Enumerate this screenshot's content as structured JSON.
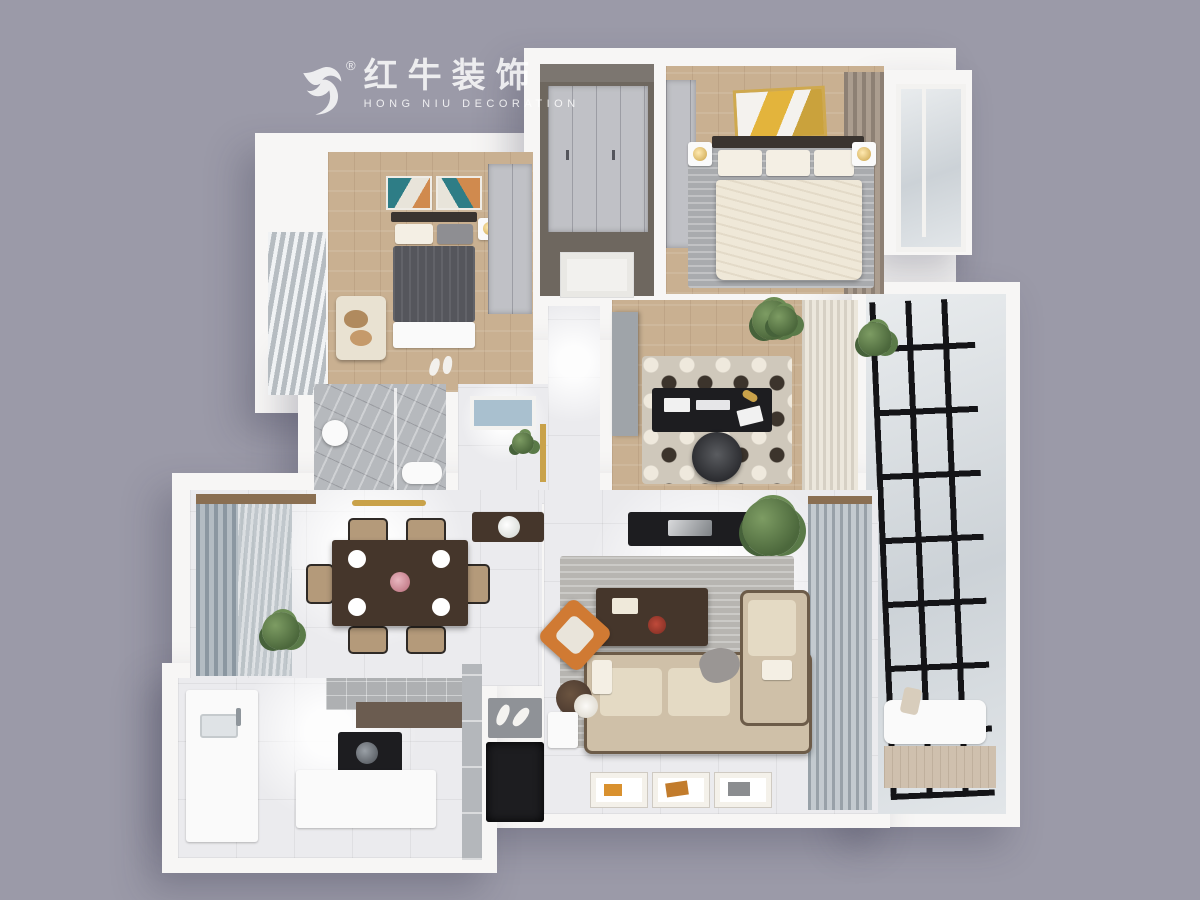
{
  "watermark": {
    "brand_cn": "红牛装饰",
    "brand_en": "HONG NIU DECORATION",
    "registered_mark": "®"
  },
  "palette": {
    "background": "#9b9aa8",
    "wall_white": "#f7f6f5",
    "wood_floor": "#c9b091",
    "tile_floor": "#ebebee",
    "marble_gray": "#b6b9bd",
    "dark_furniture": "#1d1d20",
    "brown_wood": "#45362b",
    "sofa_cream": "#e4dac4",
    "accent_orange": "#d07a33",
    "plant_green": "#5a7a48",
    "curtain_blue_gray": "#8b97a1",
    "curtain_brown": "#8d8074",
    "gold": "#c9a24a",
    "balcony_frame_black": "#141417"
  }
}
